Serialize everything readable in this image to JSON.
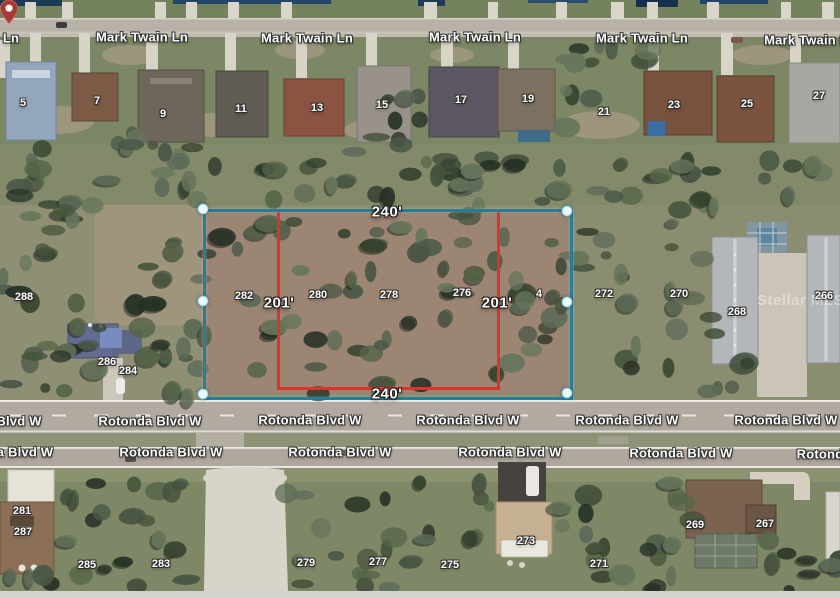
{
  "map": {
    "type": "satellite-aerial-photo",
    "annotation_colors": {
      "parcel_outline": "#2a7c95",
      "lot_divider_lines": "#e0322a",
      "pin_body": "#a83a34",
      "label_text": "#ffffff"
    },
    "street_labels": [
      {
        "text": "Ln",
        "x": 11,
        "y": 38
      },
      {
        "text": "Mark Twain Ln",
        "x": 142,
        "y": 37
      },
      {
        "text": "Mark Twain Ln",
        "x": 307,
        "y": 38
      },
      {
        "text": "Mark Twain Ln",
        "x": 475,
        "y": 37
      },
      {
        "text": "Mark Twain Ln",
        "x": 642,
        "y": 38
      },
      {
        "text": "Mark Twain L",
        "x": 806,
        "y": 40
      },
      {
        "text": "Blvd W",
        "x": 19,
        "y": 421
      },
      {
        "text": "Rotonda Blvd W",
        "x": 150,
        "y": 421
      },
      {
        "text": "Rotonda Blvd W",
        "x": 310,
        "y": 420
      },
      {
        "text": "Rotonda Blvd W",
        "x": 468,
        "y": 420
      },
      {
        "text": "Rotonda Blvd W",
        "x": 627,
        "y": 420
      },
      {
        "text": "Rotonda Blvd W",
        "x": 786,
        "y": 420
      },
      {
        "text": "a Blvd W",
        "x": 25,
        "y": 452
      },
      {
        "text": "Rotonda Blvd W",
        "x": 171,
        "y": 452
      },
      {
        "text": "Rotonda Blvd W",
        "x": 340,
        "y": 452
      },
      {
        "text": "Rotonda Blvd W",
        "x": 510,
        "y": 452
      },
      {
        "text": "Rotonda Blvd W",
        "x": 681,
        "y": 453
      },
      {
        "text": "Rotond",
        "x": 820,
        "y": 454
      }
    ],
    "lot_labels": [
      {
        "text": "5",
        "x": 23,
        "y": 103
      },
      {
        "text": "7",
        "x": 97,
        "y": 101
      },
      {
        "text": "9",
        "x": 163,
        "y": 114
      },
      {
        "text": "11",
        "x": 241,
        "y": 109
      },
      {
        "text": "13",
        "x": 317,
        "y": 108
      },
      {
        "text": "15",
        "x": 382,
        "y": 105
      },
      {
        "text": "17",
        "x": 461,
        "y": 100
      },
      {
        "text": "19",
        "x": 528,
        "y": 99
      },
      {
        "text": "21",
        "x": 604,
        "y": 112
      },
      {
        "text": "23",
        "x": 674,
        "y": 105
      },
      {
        "text": "25",
        "x": 747,
        "y": 104
      },
      {
        "text": "27",
        "x": 819,
        "y": 96
      },
      {
        "text": "288",
        "x": 24,
        "y": 297
      },
      {
        "text": "286",
        "x": 107,
        "y": 362
      },
      {
        "text": "284",
        "x": 128,
        "y": 371
      },
      {
        "text": "282",
        "x": 244,
        "y": 296
      },
      {
        "text": "280",
        "x": 318,
        "y": 295
      },
      {
        "text": "278",
        "x": 389,
        "y": 295
      },
      {
        "text": "276",
        "x": 462,
        "y": 293
      },
      {
        "text": "4",
        "x": 539,
        "y": 294
      },
      {
        "text": "272",
        "x": 604,
        "y": 294
      },
      {
        "text": "270",
        "x": 679,
        "y": 294
      },
      {
        "text": "268",
        "x": 737,
        "y": 312
      },
      {
        "text": "266",
        "x": 824,
        "y": 296
      },
      {
        "text": "281",
        "x": 22,
        "y": 511
      },
      {
        "text": "287",
        "x": 23,
        "y": 532
      },
      {
        "text": "285",
        "x": 87,
        "y": 565
      },
      {
        "text": "283",
        "x": 161,
        "y": 564
      },
      {
        "text": "279",
        "x": 306,
        "y": 563
      },
      {
        "text": "277",
        "x": 378,
        "y": 562
      },
      {
        "text": "275",
        "x": 450,
        "y": 565
      },
      {
        "text": "273",
        "x": 526,
        "y": 541
      },
      {
        "text": "271",
        "x": 599,
        "y": 564
      },
      {
        "text": "269",
        "x": 695,
        "y": 525
      },
      {
        "text": "267",
        "x": 765,
        "y": 524
      }
    ],
    "dimension_labels": [
      {
        "text": "240'",
        "x": 387,
        "y": 212
      },
      {
        "text": "240'",
        "x": 387,
        "y": 394
      },
      {
        "text": "201'",
        "x": 279,
        "y": 303
      },
      {
        "text": "201'",
        "x": 497,
        "y": 303
      }
    ],
    "watermark": {
      "text": "Stellar MLS"
    }
  }
}
